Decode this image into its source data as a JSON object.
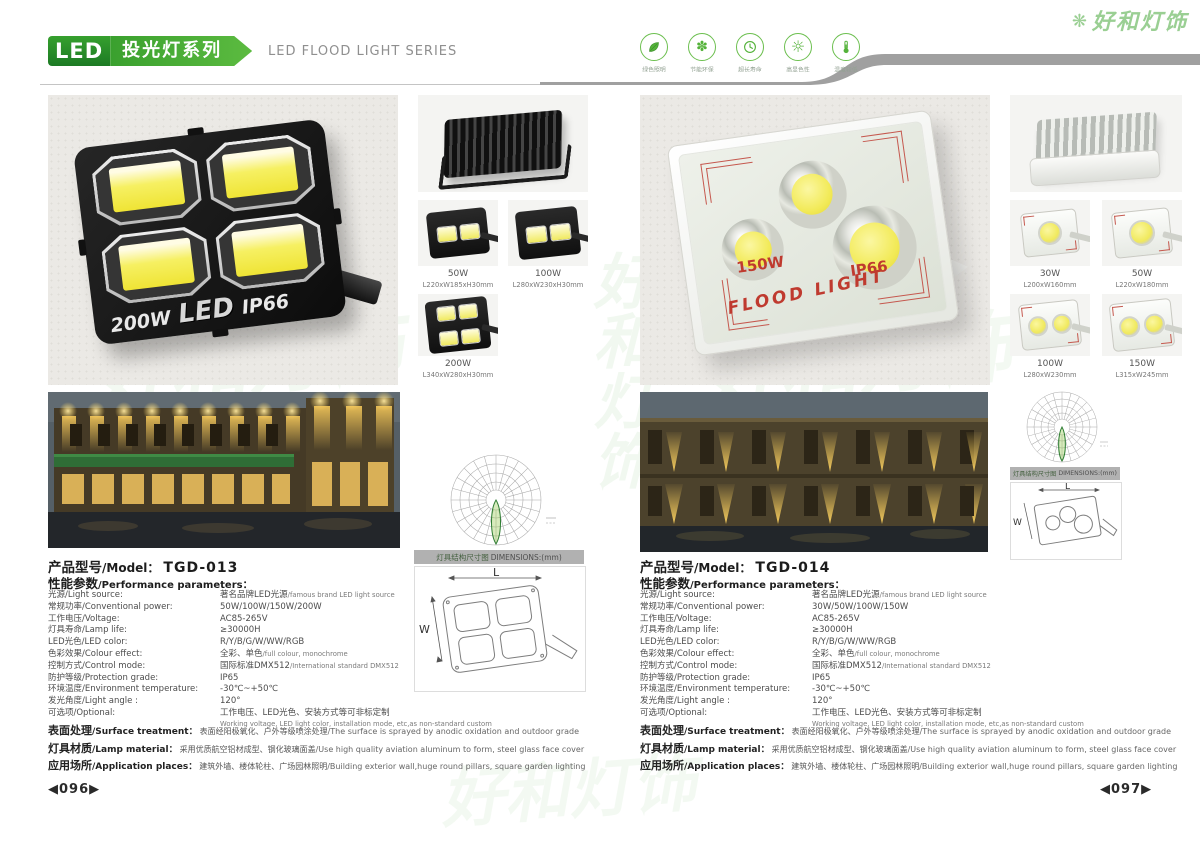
{
  "brand": {
    "watermark_text": "好和灯饰",
    "accent_green": "#4aa838",
    "swoosh_gray": "#a0a0a0"
  },
  "header": {
    "logo_text": "LED",
    "series_cn": "投光灯系列",
    "series_en": "LED FLOOD LIGHT SERIES",
    "features": [
      {
        "icon": "leaf-icon",
        "label": "绿色照明"
      },
      {
        "icon": "pinwheel-icon",
        "label": "节能环保"
      },
      {
        "icon": "clock-icon",
        "label": "超长寿命"
      },
      {
        "icon": "sun-icon",
        "label": "高显色性"
      },
      {
        "icon": "thermometer-icon",
        "label": "温度较低"
      }
    ]
  },
  "shared": {
    "dimensions_banner_cn": "灯具结构尺寸图",
    "dimensions_banner_en": "DIMENSIONS:(mm)",
    "dim_l": "L",
    "dim_w": "W",
    "model_label_cn": "产品型号",
    "model_label_en": "/Model：",
    "params_cn": "性能参数",
    "params_en": "/Performance parameters："
  },
  "footnotes": [
    {
      "label_cn": "表面处理",
      "label_en": "/Surface treatment：",
      "cn": "表面经阳极氧化、户外等级喷涂处理",
      "en": "/The surface is sprayed by anodic oxidation and outdoor grade"
    },
    {
      "label_cn": "灯具材质",
      "label_en": "/Lamp material：",
      "cn": "采用优质航空铝材成型、钢化玻璃面盖",
      "en": "/Use high quality aviation aluminum to form, steel glass face cover"
    },
    {
      "label_cn": "应用场所",
      "label_en": "/Application places：",
      "cn": "建筑外墙、楼体轮柱、广场园林照明",
      "en": "/Building exterior wall,huge round pillars, square garden lighting"
    }
  ],
  "page_left": {
    "page_number": "◀096▶",
    "marking": {
      "power": "200W",
      "mid": "LED",
      "ip": "IP66"
    },
    "thumbs": [
      {
        "power": "50W",
        "size": "L220xW185xH30mm"
      },
      {
        "power": "100W",
        "size": "L280xW230xH30mm"
      },
      {
        "power": "200W",
        "size": "L340xW280xH30mm"
      }
    ],
    "model_value": "TGD-013",
    "specs": [
      {
        "label": "光源/Light source:",
        "value": "著名品牌LED光源",
        "sub": "/famous brand LED light source"
      },
      {
        "label": "常规功率/Conventional power:",
        "value": "50W/100W/150W/200W",
        "sub": ""
      },
      {
        "label": "工作电压/Voltage:",
        "value": "AC85-265V",
        "sub": ""
      },
      {
        "label": "灯具寿命/Lamp life:",
        "value": "≥30000H",
        "sub": ""
      },
      {
        "label": "LED光色/LED color:",
        "value": "R/Y/B/G/W/WW/RGB",
        "sub": ""
      },
      {
        "label": "色彩效果/Colour effect:",
        "value": "全彩、单色",
        "sub": "/full colour, monochrome"
      },
      {
        "label": "控制方式/Control mode:",
        "value": "国际标准DMX512",
        "sub": "/International standard DMX512"
      },
      {
        "label": "防护等级/Protection grade:",
        "value": "IP65",
        "sub": ""
      },
      {
        "label": "环境温度/Environment temperature:",
        "value": "-30℃~+50℃",
        "sub": ""
      },
      {
        "label": "发光角度/Light angle :",
        "value": "120°",
        "sub": ""
      },
      {
        "label": "可选项/Optional:",
        "value": "工作电压、LED光色、安装方式等可非标定制",
        "sub": "Working voltage, LED light color, installation mode, etc,as non-standard custom"
      }
    ]
  },
  "page_right": {
    "page_number": "◀097▶",
    "marking": {
      "power": "150W",
      "mid": "FLOOD LIGHT",
      "ip": "IP66"
    },
    "thumbs": [
      {
        "power": "30W",
        "size": "L200xW160mm"
      },
      {
        "power": "50W",
        "size": "L220xW180mm"
      },
      {
        "power": "100W",
        "size": "L280xW230mm"
      },
      {
        "power": "150W",
        "size": "L315xW245mm"
      }
    ],
    "model_value": "TGD-014",
    "specs": [
      {
        "label": "光源/Light source:",
        "value": "著名品牌LED光源",
        "sub": "/famous brand LED light source"
      },
      {
        "label": "常规功率/Conventional power:",
        "value": "30W/50W/100W/150W",
        "sub": ""
      },
      {
        "label": "工作电压/Voltage:",
        "value": "AC85-265V",
        "sub": ""
      },
      {
        "label": "灯具寿命/Lamp life:",
        "value": "≥30000H",
        "sub": ""
      },
      {
        "label": "LED光色/LED color:",
        "value": "R/Y/B/G/W/WW/RGB",
        "sub": ""
      },
      {
        "label": "色彩效果/Colour effect:",
        "value": "全彩、单色",
        "sub": "/full colour, monochrome"
      },
      {
        "label": "控制方式/Control mode:",
        "value": "国际标准DMX512",
        "sub": "/International standard DMX512"
      },
      {
        "label": "防护等级/Protection grade:",
        "value": "IP65",
        "sub": ""
      },
      {
        "label": "环境温度/Environment temperature:",
        "value": "-30℃~+50℃",
        "sub": ""
      },
      {
        "label": "发光角度/Light angle :",
        "value": "120°",
        "sub": ""
      },
      {
        "label": "可选项/Optional:",
        "value": "工作电压、LED光色、安装方式等可非标定制",
        "sub": "Working voltage, LED light color, installation mode, etc,as non-standard custom"
      }
    ]
  }
}
